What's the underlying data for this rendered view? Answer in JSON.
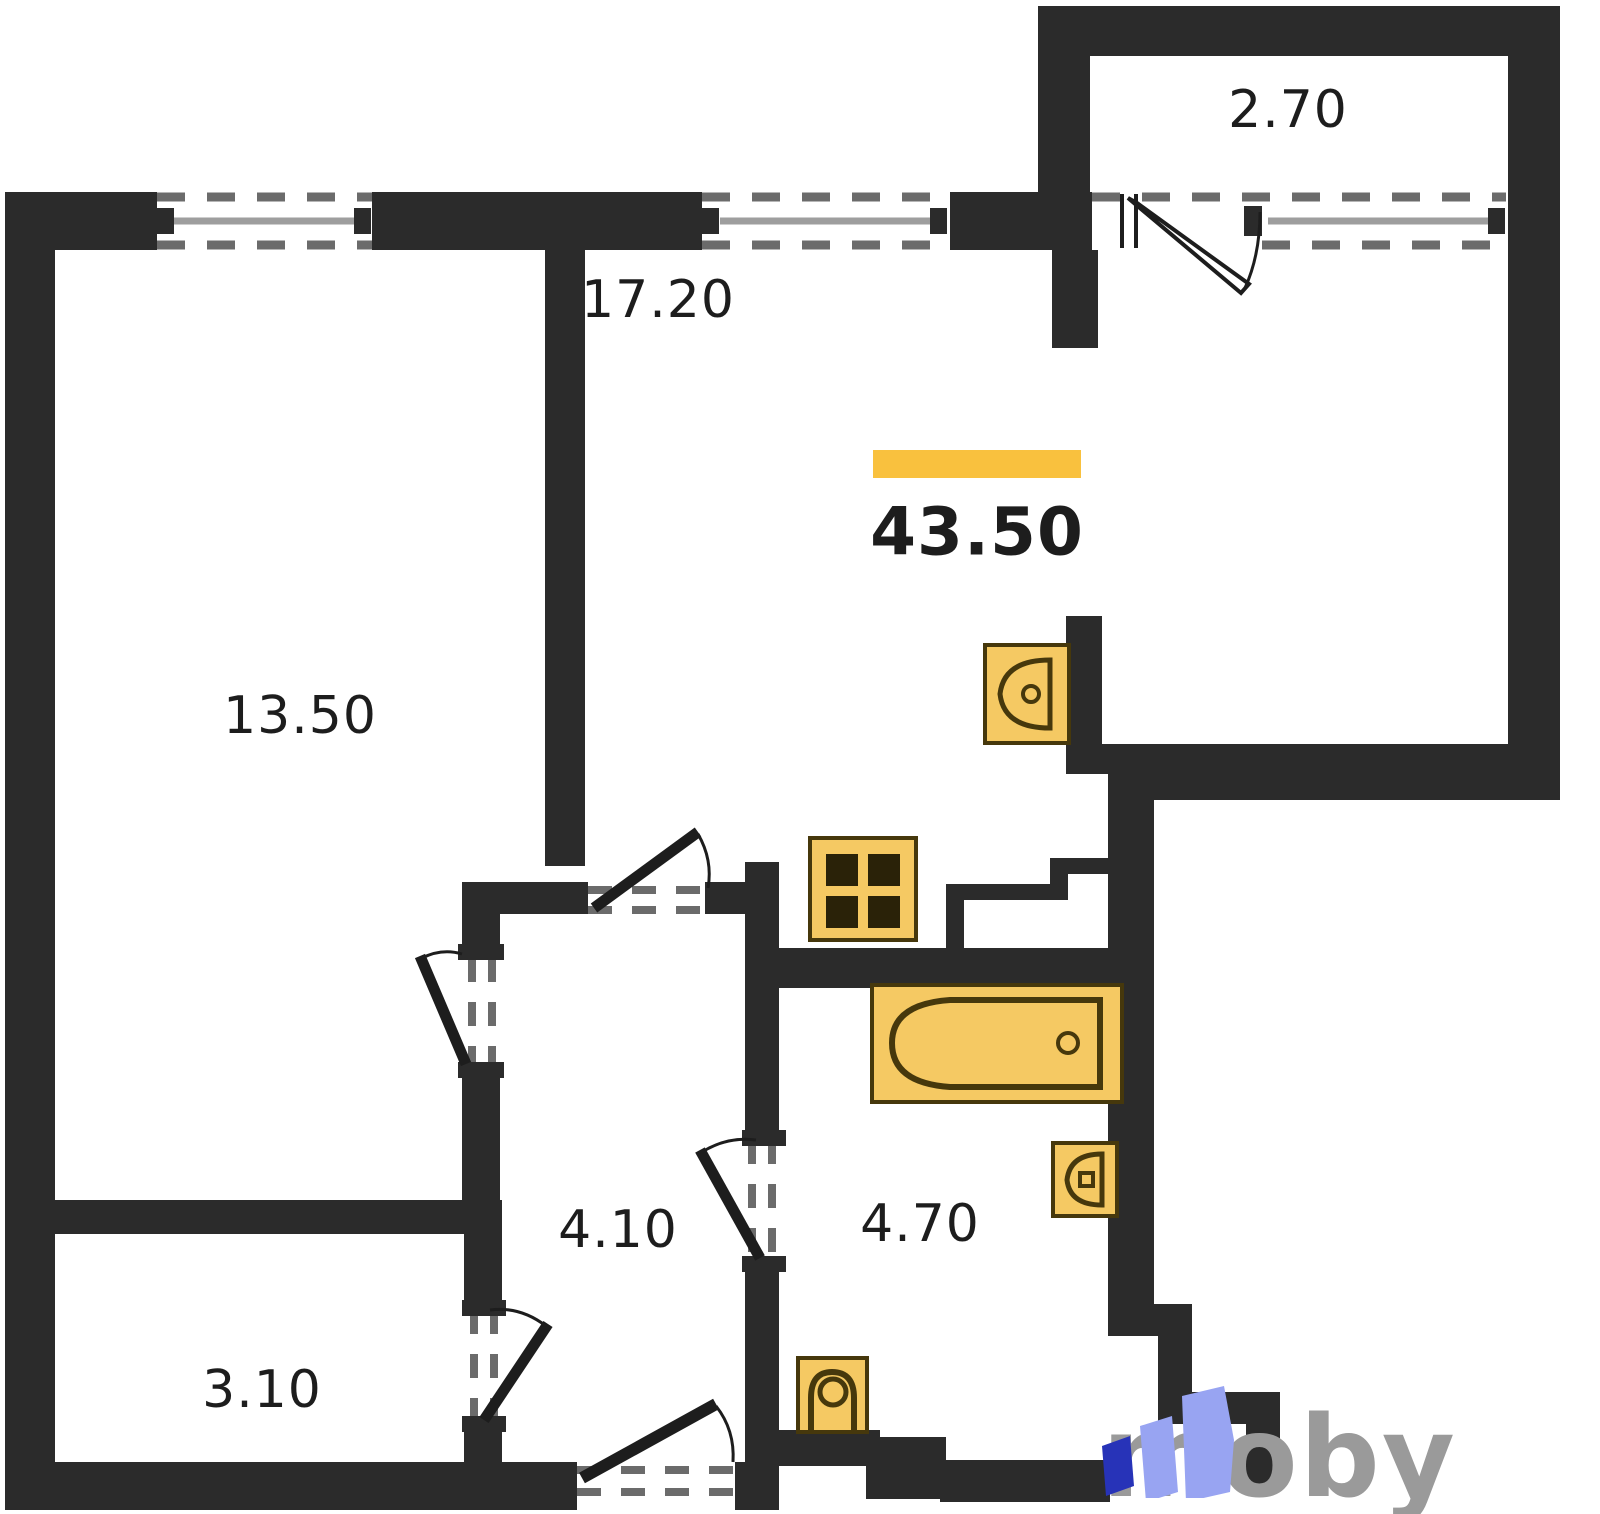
{
  "plan": {
    "type": "apartment-floor-plan",
    "total_area": "43.50",
    "rooms": [
      {
        "id": "living-kitchen",
        "area": "17.20"
      },
      {
        "id": "bedroom",
        "area": "13.50"
      },
      {
        "id": "balcony",
        "area": "2.70"
      },
      {
        "id": "hallway",
        "area": "4.10"
      },
      {
        "id": "bathroom",
        "area": "4.70"
      },
      {
        "id": "storage",
        "area": "3.10"
      }
    ],
    "fixtures": [
      "kitchen-sink-icon",
      "stove-icon",
      "bathtub-icon",
      "washbasin-icon",
      "toilet-icon"
    ],
    "colors": {
      "wall": "#2b2b2b",
      "accent_bar": "#f9c13e",
      "fixture_fill": "#f5c963",
      "fixture_stroke": "#46380c",
      "dash": "#6b6b6b",
      "window_line": "#9e9e9e",
      "label_text": "#1d1d1d",
      "logo_text": "#9a9a9a",
      "logo_light": "#98a4f2",
      "logo_dark": "#2733b8"
    }
  },
  "branding": {
    "logo_text": "moby"
  }
}
